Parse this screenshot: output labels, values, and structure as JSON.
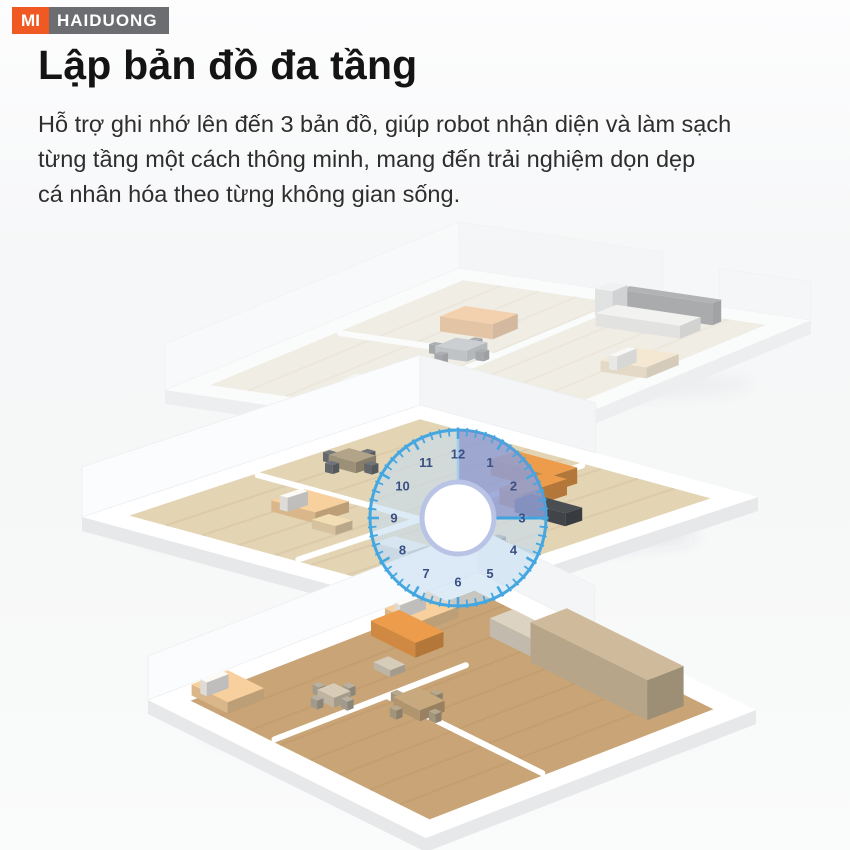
{
  "header": {
    "logo": {
      "mi_label": "MI",
      "store_label": "HAIDUONG",
      "mi_bg_color": "#f05a22",
      "store_bg_color": "#6c6d70",
      "text_color": "#ffffff"
    }
  },
  "content": {
    "title": "Lập bản đồ đa tầng",
    "description_lines": [
      "Hỗ trợ ghi nhớ lên đến 3 bản đồ, giúp robot nhận diện và làm sạch",
      "từng tầng một cách thông minh, mang đến trải nghiệm dọn dẹp",
      "cá nhân hóa theo từng không gian sống."
    ]
  },
  "illustration": {
    "description": "three stacked isometric floor plans with a translucent clock overlay highlighting the 12-to-3 sector",
    "floors": [
      {
        "name": "top-floor-plan"
      },
      {
        "name": "middle-floor-plan"
      },
      {
        "name": "bottom-floor-plan"
      }
    ],
    "clock": {
      "numerals": [
        "12",
        "1",
        "2",
        "3",
        "4",
        "5",
        "6",
        "7",
        "8",
        "9",
        "10",
        "11"
      ],
      "highlighted_sector": "12-to-3",
      "ring_color": "#45a7e0",
      "face_color": "rgba(199,221,241,0.60)",
      "sector_color": "rgba(124,136,200,0.62)",
      "numeral_color": "#3a5085",
      "hub_color": "#ffffff",
      "hub_ring_color": "#b9c3e6"
    },
    "palette": {
      "sofa_orange": "#ec9c4b",
      "sofa_orange_faded": "#f2b272",
      "bed_peach": "#f7d09d",
      "bed_beige": "#f3ddb4",
      "wood_floor_light": "#ece5d4",
      "wood_floor_mid": "#e3d4b4",
      "wood_floor_dark": "#c9a476",
      "cabinet_wood": "#cfbb9b",
      "counter_dark": "#4a4e53",
      "appliance_white": "#ededee",
      "chair_gray": "#70757b",
      "table_gray": "#a9afb5",
      "table_wood": "#c8a97e",
      "rug_blue": "#b7cdd8",
      "wall_white": "#ffffff"
    }
  }
}
